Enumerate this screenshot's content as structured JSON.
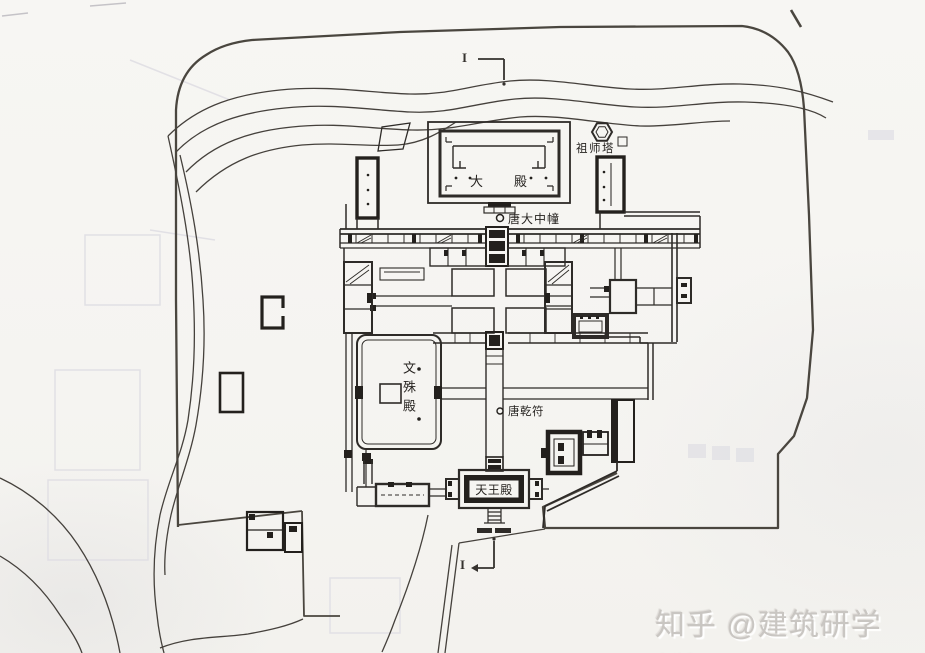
{
  "colors": {
    "paper": "#f6f5f2",
    "ink": "#2e2b28",
    "heavy_wall": "#23201d",
    "terrain_line": "#45413c",
    "watermark": "#c9c6c2"
  },
  "plan_labels": {
    "main_hall": "大　殿",
    "patriarch_pagoda": "祖师塔",
    "tang_dazhong_pillar": "唐大中幢",
    "manjusri_hall": "文殊殿",
    "tang_qianfu_pillar": "唐乾符",
    "heavenly_kings_hall": "天王殿"
  },
  "section_markers": {
    "top": "I",
    "bottom": "I"
  },
  "watermark": {
    "text": "知乎 @建筑研学ers"
  }
}
